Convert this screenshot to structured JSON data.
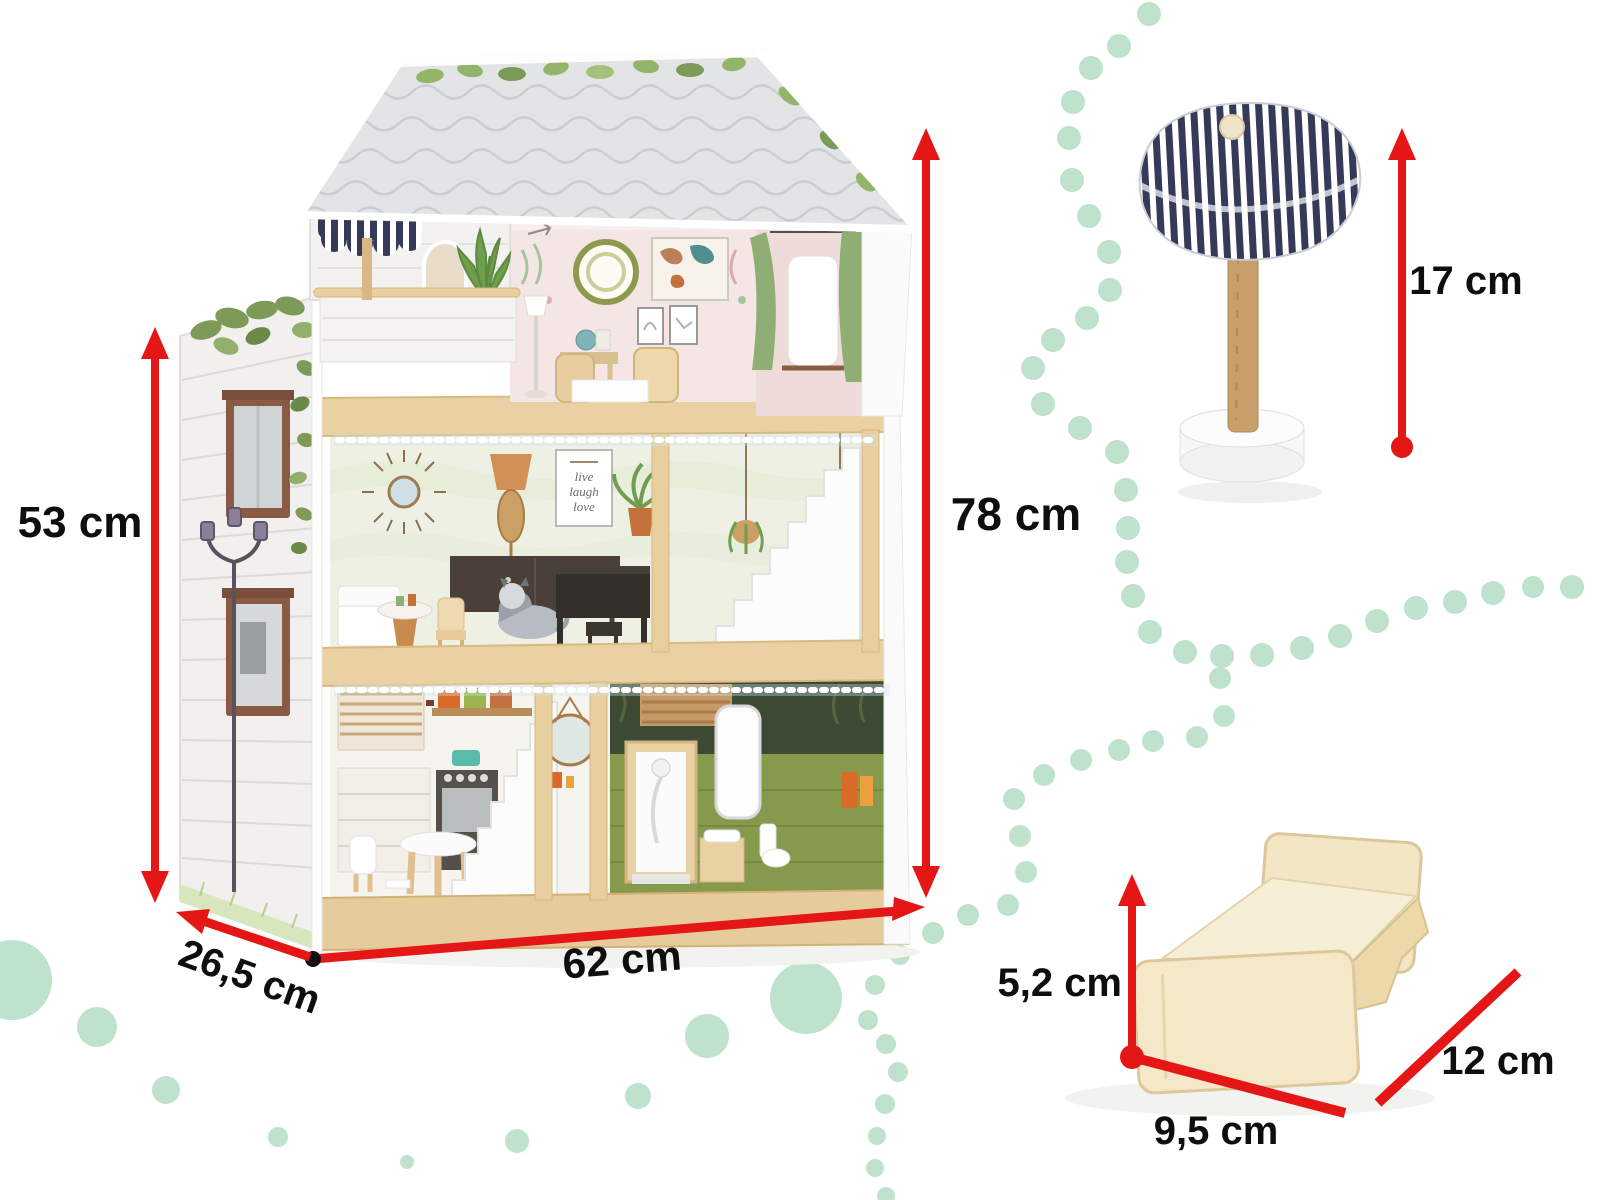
{
  "image": {
    "kind": "product dimensions illustration",
    "subject": "wooden dollhouse with LED lighting, doll stool and doll bed"
  },
  "measurements": {
    "house_height": {
      "label": "78 cm"
    },
    "front_height": {
      "label": "53 cm"
    },
    "width": {
      "label": "62 cm"
    },
    "depth": {
      "label": "26,5 cm"
    },
    "stool_height": {
      "label": "17 cm"
    },
    "bed_height": {
      "label": "5,2 cm"
    },
    "bed_width": {
      "label": "9,5 cm"
    },
    "bed_length": {
      "label": "12 cm"
    }
  },
  "house": {
    "poster": {
      "line1": "live",
      "line2": "laugh",
      "line3": "love"
    }
  },
  "colors": {
    "dimension_red": "#e51616",
    "label_black": "#0e0e0e",
    "mint_dot": "#bfe2cd",
    "pine_wood": "#ead1a4",
    "navy_stripe": "#343a57",
    "roof_gray": "#e3e4e6"
  }
}
